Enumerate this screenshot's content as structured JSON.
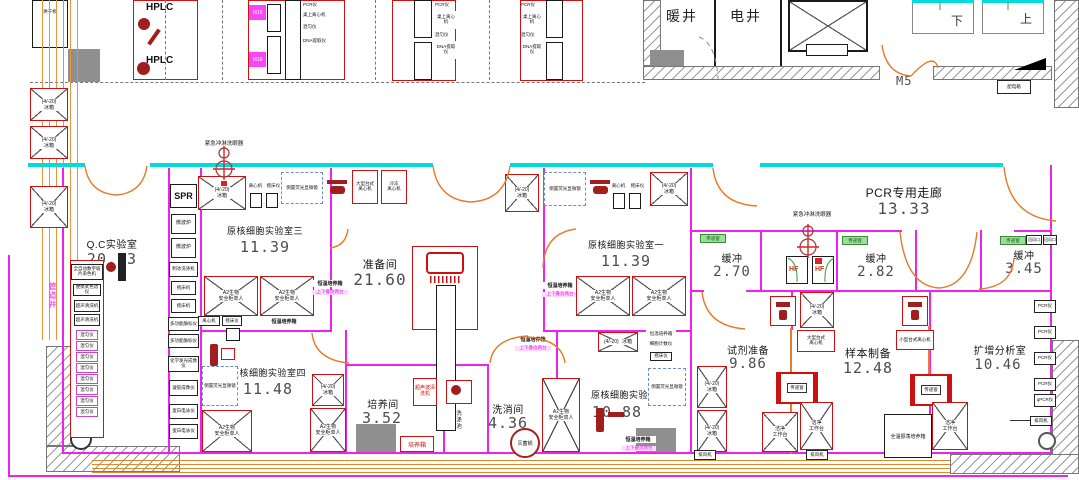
{
  "rooms": {
    "qc": {
      "name": "Q.C实验室",
      "area": "20.03"
    },
    "lab3": {
      "name": "原核细胞实验室三",
      "area": "11.39"
    },
    "prep": {
      "name": "准备间",
      "area": "21.60"
    },
    "lab1": {
      "name": "原核细胞实验室一",
      "area": "11.39"
    },
    "corridor": {
      "name": "PCR专用走廊",
      "area": "13.33"
    },
    "buffer1": {
      "name": "缓冲",
      "area": "2.70"
    },
    "buffer2": {
      "name": "缓冲",
      "area": "2.82"
    },
    "buffer3": {
      "name": "缓冲",
      "area": "3.45"
    },
    "lab4": {
      "name": "原核细胞实验室四",
      "area": "11.48"
    },
    "culture": {
      "name": "培养间",
      "area": "3.52"
    },
    "wash": {
      "name": "洗消间",
      "area": "4.36"
    },
    "lab2": {
      "name": "原核细胞实验室二",
      "area": "10.88"
    },
    "reagent": {
      "name": "试剂准备",
      "area": "9.86"
    },
    "sample": {
      "name": "样本制备",
      "area": "12.48"
    },
    "amplification": {
      "name": "扩增分析室",
      "area": "10.46"
    },
    "heating_shaft": {
      "name": "暖井"
    },
    "electric_shaft": {
      "name": "电井"
    }
  },
  "labels": {
    "door_m5": "M5",
    "door_tag": "M10",
    "stair_down": "下",
    "stair_up": "上",
    "pipe_shaft": "管道井",
    "power_box": "配电箱",
    "emergency_shower": "紧急冲淋洗眼器",
    "hf": "HF",
    "pass_window": "传递窗",
    "stacked_note": "上下叠放两台",
    "sink": "洗涤池",
    "autoclave": "灭菌锅",
    "incubator_small": "培养箱",
    "exhaust_fan": "排风机",
    "return_air": "回风口"
  },
  "equipment": {
    "fridge_l1": "(4/-20)",
    "fridge_l2": "冰箱",
    "hplc": "HPLC",
    "spr": "SPR",
    "dryer": "烘干机",
    "bsc_single_l1": "A2生物",
    "bsc_single_l2": "安全柜单人",
    "bsc_double_l1": "A2生物",
    "bsc_double_l2": "安全柜双人",
    "incubator": "恒温培养箱",
    "inverted_microscope": "倒置荧光显微镜",
    "centrifuge_large_l1": "大型台式",
    "centrifuge_large_l2": "离心机",
    "centrifuge_cold_l1": "冷冻",
    "centrifuge_cold_l2": "离心机",
    "centrifuge_small": "小型台式离心机",
    "clean_bench_l1": "洁净",
    "clean_bench_l2": "工作台",
    "pcr": "PCR仪",
    "qpcr": "qPCR仪",
    "desk_centrifuge": "桌上离心机",
    "mixer": "混匀仪",
    "dna_extractor": "DNA提取仪",
    "microwave": "微波炉",
    "ice_washer": "制冰洗涤机",
    "shaker": "摇床机",
    "shaker2": "摇床仪",
    "plate_reader": "多功能酶标仪",
    "chemilum": "化学发光成像仪",
    "gel_imager": "凝胶成像仪",
    "electrophoresis": "蛋白电泳仪",
    "slide_stainer": "全自动数字玻片染色机",
    "portable_chrom": "便携式色谱仪",
    "ultrasonic": "超声清洗机",
    "ultrasonic_wash": "超声波清洗机",
    "cell_counter": "细胞计数仪",
    "centrifuge": "离心机",
    "auto_incubator": "全温振荡培养箱"
  }
}
